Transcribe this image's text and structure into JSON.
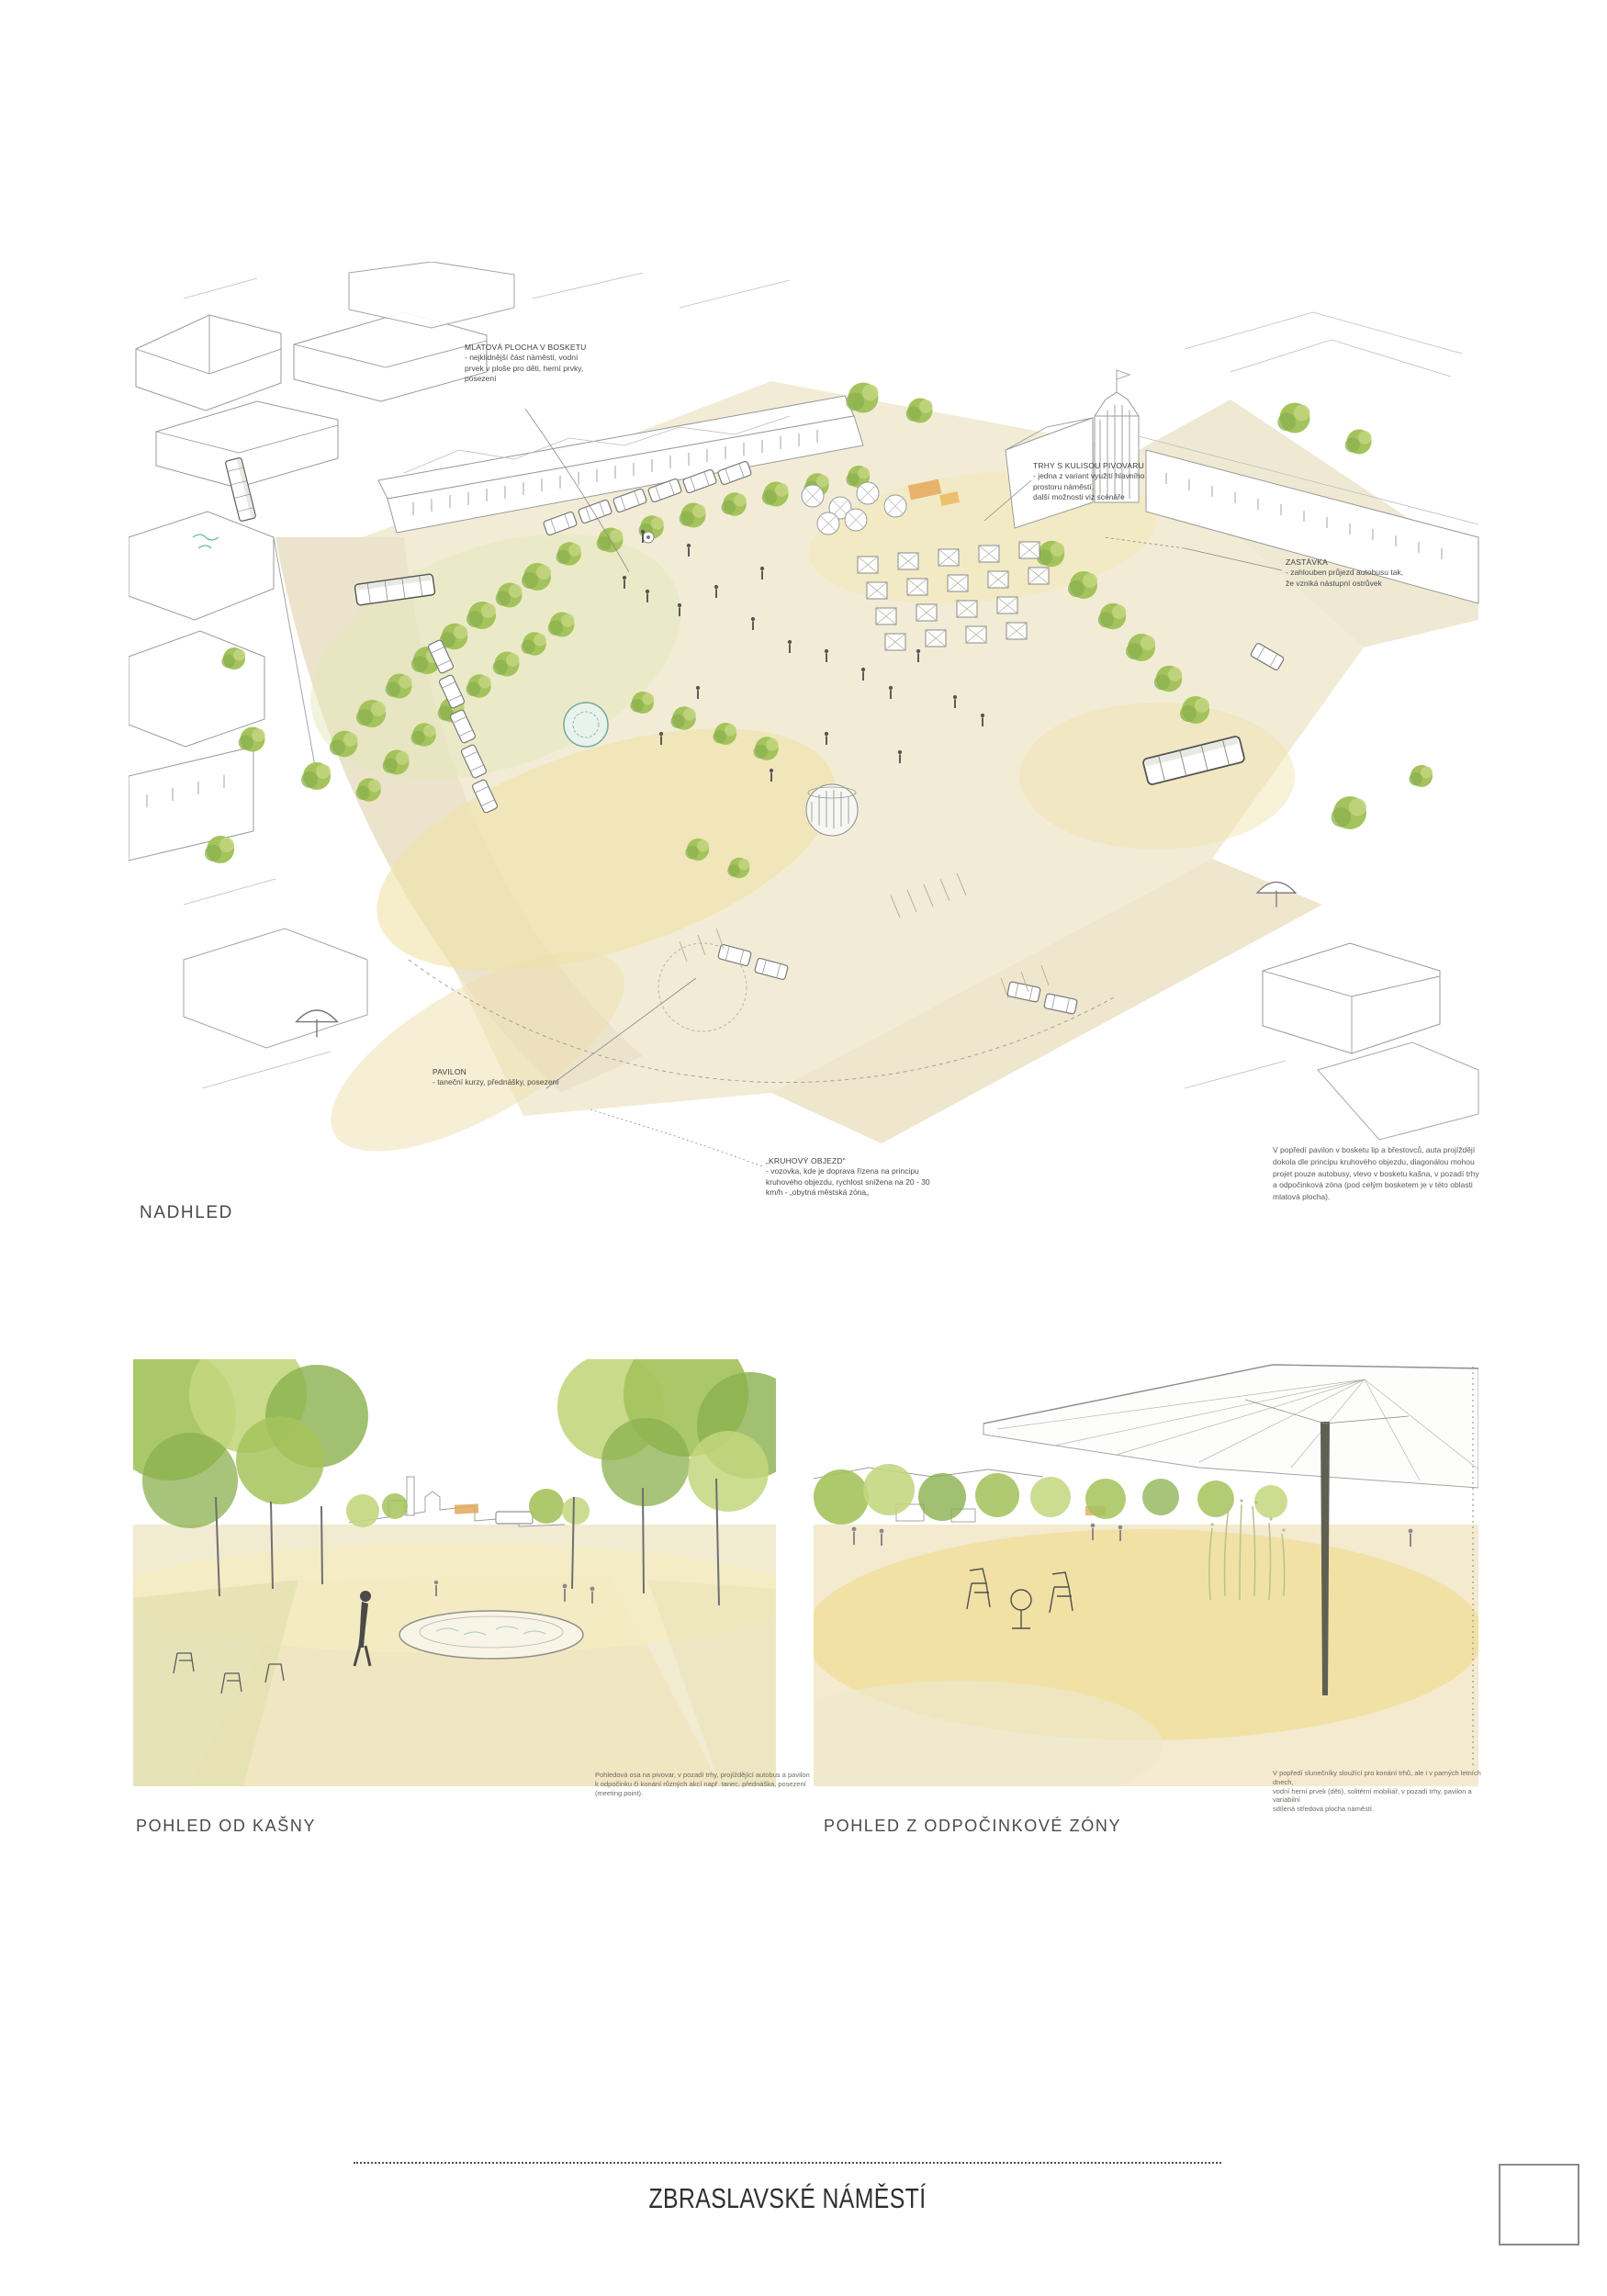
{
  "page": {
    "background": "#ffffff",
    "board_title": "ZBRASLAVSKÉ NÁMĚSTÍ"
  },
  "palette": {
    "foliage_green": "#a4c35c",
    "foliage_light": "#c3d67e",
    "foliage_dark": "#8ab04e",
    "ground_cream": "#f2ecd7",
    "ground_yellow": "#f0e2a6",
    "pencil_gray": "#9a9a9a",
    "accent_teal": "#74aa9c",
    "text_dark": "#4c4c4c"
  },
  "aerial": {
    "label": "NADHLED",
    "annotations": [
      {
        "id": "mlatova",
        "title": "MLATOVÁ PLOCHA V BOSKETU",
        "body": "- nejklidnější část náměstí, vodní\nprvek v ploše pro děti, herní prvky,\nposezení"
      },
      {
        "id": "trhy",
        "title": "TRHY S KULISOU PIVOVARU",
        "body": "- jedna z variant využití hlavního\nprostoru náměstí,\ndalší možnosti viz scénáře"
      },
      {
        "id": "zastavka",
        "title": "ZASTÁVKA",
        "body": "- zahlouben průjezd autobusu tak,\nže vzniká nástupní ostrůvek"
      },
      {
        "id": "pavilon",
        "title": "PAVILON",
        "body": "- taneční kurzy, přednášky, posezení"
      },
      {
        "id": "kruhovy",
        "title": "„KRUHOVÝ OBJEZD“",
        "body": "- vozovka, kde je doprava řízena na principu\nkruhového objezdu, rychlost snížena na 20 - 30\nkm/h - „obytná městská zóna„"
      }
    ],
    "description": "V popředí pavilon v bosketu lip a břestovců, auta projíždějí\ndokola dle principu kruhového objezdu, diagonálou mohou\nprojet pouze autobusy, vlevo v bosketu kašna, v pozadí trhy\na odpočinková zóna (pod celým bosketem je v této oblasti\nmlatová plocha)."
  },
  "views": [
    {
      "id": "kasna",
      "label": "POHLED OD KAŠNY",
      "caption": "Pohledová osa na pivovar, v pozadí trhy, projíždějící autobus a pavilon\nk odpočinku či konání různých akcí např. tanec, přednáška, posezení\n(meeting point)."
    },
    {
      "id": "odpocinkova",
      "label": "POHLED Z ODPOČINKOVÉ ZÓNY",
      "caption": "V popředí slunečníky sloužící pro konání trhů, ale i v parných letních dnech,\nvodní herní prvek (děti), solitérní mobiliář, v pozadí trhy, pavilon a variabilní\nsdílená středová plocha náměstí."
    }
  ]
}
